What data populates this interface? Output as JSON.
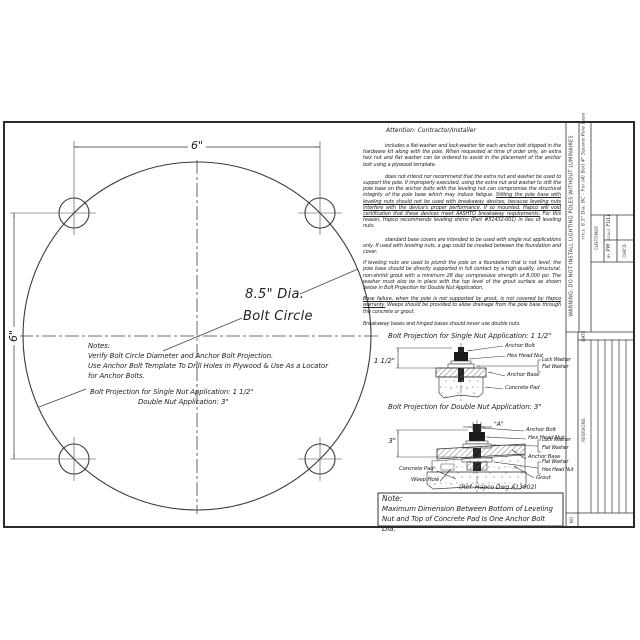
{
  "drawing": {
    "template_view": {
      "dim_top": "6\"",
      "dim_left": "6\"",
      "dia_label_line1": "8.5\" Dia.",
      "dia_label_line2": "Bolt Circle",
      "notes_title": "Notes:",
      "notes_line1": "Verify Bolt Circle Diameter and Anchor Bolt Projection.",
      "notes_line2": "Use Anchor Bolt Template To Drill Holes in Plywood & Use As a Locator",
      "notes_line3": "for Anchor Bolts.",
      "notes_proj_single": "Bolt Projection for Single Nut Application:   1 1/2\"",
      "notes_proj_double": "Double Nut Application:   3\""
    },
    "attention": {
      "heading": "Attention: Contractor/Installer",
      "p1": "includes a flat-washer and lock-washer for each anchor bolt shipped in the hardware kit along with the pole. When requested at time of order only, an extra hex nut and flat washer can be ordered to assist in the placement of the anchor bolt using a plywood template.",
      "p2a": "does not intend nor recommend that the extra nut and washer be used to support the pole. If improperly executed, using the extra nut and washer to stilt the pole base on the anchor bolts with the leveling nut can compromise the structural integrity of the pole base which may induce fatigue. ",
      "p2b": "Stilting the pole base with leveling nuts should not be used with breakaway devices, because leveling nuts interfere with the device's proper performance. If so mounted, Hapco will void certification that these devices meet AASHTO breakaway requirements.",
      "p2c": " For this reason, Hapco recommends leveling shims (Part #51432-001) in lieu of leveling nuts.",
      "p3": "standard base covers are intended to be used with single nut applications only. If used with leveling nuts, a gap could be created between the foundation and cover.",
      "p4": "If leveling nuts are used to plumb the pole on a foundation that is not level, the pole base should be directly supported in full contact by a high quality, structural, non-shrink grout with a minimum 28 day compressive strength of 8,000 psi. The washer must also be in place with the top level of the grout surface as shown below in Bolt Projection for Double Nut Application.",
      "p5a": "Base failure, when the pole is not supported by grout, is not covered by Hapco warranty.",
      "p5b": " Weeps should be provided to allow drainage from the pole base through the concrete or grout.",
      "p6": "Breakaway bases and hinged bases should never use double nuts."
    },
    "single_nut": {
      "heading": "Bolt Projection for Single Nut Application:   1 1/2\"",
      "dim": "1 1/2\"",
      "label_anchor_bolt": "Anchor Bolt",
      "label_hex_head_nut": "Hex Head Nut",
      "label_lock_washer": "Lock Washer",
      "label_flat_washer": "Flat Washer",
      "label_anchor_base": "Anchor Base",
      "label_concrete_pad": "Concrete Pad"
    },
    "double_nut": {
      "heading": "Bolt Projection for Double Nut Application:   3\"",
      "dim_a": "\"A\"",
      "dim": "3\"",
      "label_anchor_bolt": "Anchor Bolt",
      "label_hex_head_nut": "Hex Head Nut",
      "label_lock_washer": "Lock Washer",
      "label_flat_washer": "Flat Washer",
      "label_anchor_base": "Anchor Base",
      "label_flat_washer2": "Flat Washer",
      "label_hex_head_nut2": "Hex Head Nut",
      "label_grout": "Grout",
      "label_concrete_pad": "Concrete Pad",
      "label_weep_hole": "Weep Hole",
      "ref": "(Ref. Hapco Dwg A13902)"
    },
    "note_box": {
      "title": "Note:",
      "body": "Maximum Dimension Between Bottom of Leveling Nut and Top of Concrete Pad Is One Anchor Bolt Dia."
    },
    "title_block": {
      "warning": "WARNING:  DO  NOT  INSTALL  LIGHTING  POLES  WITHOUT  LUMINAIRES",
      "title_label": "TITLE",
      "title_value": "8.5\" Dia. BC - For (4) Bolt 4\" Square Pole Base",
      "customer_label": "CUSTOMER",
      "scale_label": "SCALE",
      "scale_value": "FULL",
      "by_label": "BY",
      "by_value": "PM",
      "chkd_label": "CHK'D",
      "date_label": "DATE",
      "revisions_label": "REVISIONS",
      "no_label": "NO"
    }
  }
}
